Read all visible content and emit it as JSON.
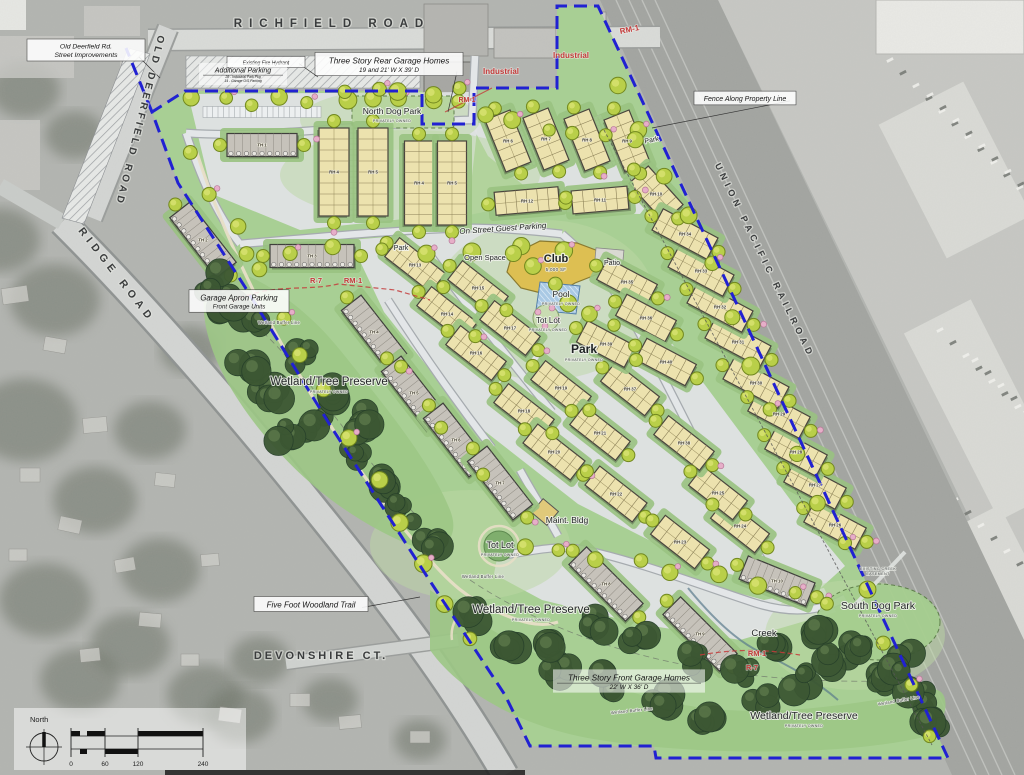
{
  "colors": {
    "boundary": "#2121d2",
    "zoning_red": "#c43b3b",
    "site_green": "#a8cf94",
    "preserve_green": "#9cc785",
    "pavement": "#dfe2e4",
    "rh_fill": "#ece2ae",
    "th_fill": "#c6c2ba",
    "club_fill": "#ddbf52",
    "pool_fill": "#a9c9e4",
    "tree_yellow": "#b9cf49",
    "tree_dark": "#3c5733",
    "shrub_pink": "#e6aec8"
  },
  "legend": {
    "north_label": "North",
    "scale_ticks": [
      "0",
      "60",
      "120",
      "240"
    ]
  },
  "labels": [
    {
      "t": "RICHFIELD ROAD",
      "x": 332,
      "y": 27,
      "s": 11.5,
      "cls": "road",
      "ls": 7
    },
    {
      "t": "OLD DEERFIELD ROAD",
      "x": 137,
      "y": 120,
      "s": 10,
      "cls": "road",
      "ls": 3.5,
      "r": 104
    },
    {
      "t": "RIDGE ROAD",
      "x": 114,
      "y": 277,
      "s": 10.5,
      "cls": "road",
      "ls": 5,
      "r": 52
    },
    {
      "t": "UNION PACIFIC RAILROAD",
      "x": 762,
      "y": 262,
      "s": 9,
      "cls": "road",
      "ls": 4.5,
      "r": 64
    },
    {
      "t": "DEVONSHIRE CT.",
      "x": 321,
      "y": 659,
      "s": 11,
      "cls": "road",
      "ls": 3
    },
    {
      "t": "RM-1",
      "x": 630,
      "y": 32,
      "s": 8,
      "cls": "red",
      "r": -12
    },
    {
      "t": "RM-1",
      "x": 467,
      "y": 102,
      "s": 7,
      "cls": "red"
    },
    {
      "t": "R-7",
      "x": 316,
      "y": 283,
      "s": 7.5,
      "cls": "red"
    },
    {
      "t": "RM-1",
      "x": 353,
      "y": 283,
      "s": 7.5,
      "cls": "red"
    },
    {
      "t": "RM-1",
      "x": 757,
      "y": 656,
      "s": 7.5,
      "cls": "red"
    },
    {
      "t": "R-7",
      "x": 752,
      "y": 670,
      "s": 7.5,
      "cls": "red"
    },
    {
      "t": "Industrial",
      "x": 501,
      "y": 74,
      "s": 8,
      "cls": "red"
    },
    {
      "t": "Industrial",
      "x": 571,
      "y": 58,
      "s": 8,
      "cls": "red"
    },
    {
      "t": "North Dog Park",
      "x": 392,
      "y": 114,
      "s": 8.5,
      "cls": "area",
      "sub": "PRIVATELY OWNED"
    },
    {
      "t": "On Street Guest Parking",
      "x": 503,
      "y": 231,
      "s": 8,
      "cls": "ital",
      "r": -4
    },
    {
      "t": "Open Space",
      "x": 485,
      "y": 260,
      "s": 7.5,
      "cls": "area"
    },
    {
      "t": "Club",
      "x": 556,
      "y": 262,
      "s": 11,
      "cls": "areaB"
    },
    {
      "t": "5,000 SF",
      "x": 556,
      "y": 271,
      "s": 4.5,
      "cls": "tiny"
    },
    {
      "t": "Patio",
      "x": 612,
      "y": 265,
      "s": 7,
      "cls": "area"
    },
    {
      "t": "Pool",
      "x": 561,
      "y": 297,
      "s": 8.5,
      "cls": "area",
      "sub": "PRIVATELY OWNED"
    },
    {
      "t": "Tot Lot",
      "x": 548,
      "y": 323,
      "s": 8,
      "cls": "area",
      "sub": "PRIVATELY OWNED"
    },
    {
      "t": "Park",
      "x": 584,
      "y": 353,
      "s": 12,
      "cls": "areaB",
      "sub": "PRIVATELY OWNED"
    },
    {
      "t": "Park",
      "x": 652,
      "y": 142,
      "s": 7,
      "cls": "area",
      "r": -12
    },
    {
      "t": "Park",
      "x": 401,
      "y": 250,
      "s": 7,
      "cls": "area"
    },
    {
      "t": "Maint. Bldg",
      "x": 567,
      "y": 523,
      "s": 8.5,
      "cls": "area"
    },
    {
      "t": "Tot Lot",
      "x": 500,
      "y": 548,
      "s": 9,
      "cls": "area",
      "sub": "PRIVATELY OWNED"
    },
    {
      "t": "South Dog Park",
      "x": 878,
      "y": 609,
      "s": 10.5,
      "cls": "area",
      "sub": "PRIVATELY OWNED"
    },
    {
      "t": "Creek",
      "x": 764,
      "y": 636,
      "s": 9.5,
      "cls": "area"
    },
    {
      "t": "Wetland/Tree Preserve",
      "x": 329,
      "y": 385,
      "s": 11.5,
      "cls": "area",
      "sub": "PRIVATELY OWNED"
    },
    {
      "t": "Wetland/Tree Preserve",
      "x": 531,
      "y": 613,
      "s": 11.5,
      "cls": "area",
      "sub": "PRIVATELY OWNED"
    },
    {
      "t": "Wetland/Tree Preserve",
      "x": 804,
      "y": 719,
      "s": 10.5,
      "cls": "area",
      "sub": "PRIVATELY OWNED"
    },
    {
      "t": "Wetland Buffer Line",
      "x": 279,
      "y": 324,
      "s": 4.2,
      "cls": "tiny"
    },
    {
      "t": "Wetland Buffer Line",
      "x": 483,
      "y": 578,
      "s": 4.2,
      "cls": "tiny"
    },
    {
      "t": "Wetland Buffer Line",
      "x": 632,
      "y": 712,
      "s": 4.2,
      "cls": "tiny",
      "r": -6
    },
    {
      "t": "Wetland Buffer Line",
      "x": 899,
      "y": 702,
      "s": 4.2,
      "cls": "tiny",
      "r": -10
    },
    {
      "t": "EXISTING CREEK",
      "x": 878,
      "y": 570,
      "s": 3.8,
      "cls": "tiny"
    },
    {
      "t": "EASEMENT",
      "x": 878,
      "y": 575,
      "s": 3.8,
      "cls": "tiny"
    }
  ],
  "callouts": [
    {
      "lines": [
        "Old Deerfield Rd.",
        "Street Improvements"
      ],
      "x": 86,
      "y": 50,
      "w": 118,
      "sizes": [
        6.8,
        6.8
      ],
      "lead": [
        160,
        78
      ]
    },
    {
      "lines": [
        "Three Story Rear Garage Homes",
        "19 and 21' W X 39' D"
      ],
      "x": 389,
      "y": 64,
      "w": 148,
      "sizes": [
        8.2,
        6.4
      ],
      "lead": [
        448,
        112
      ]
    },
    {
      "lines": [
        "Fence Along Property Line"
      ],
      "x": 745,
      "y": 98,
      "w": 102,
      "sizes": [
        7
      ],
      "lead": [
        652,
        128
      ]
    },
    {
      "lines": [
        "Five Foot Woodland Trail"
      ],
      "x": 311,
      "y": 604,
      "w": 114,
      "sizes": [
        8
      ],
      "lead": [
        420,
        597
      ]
    },
    {
      "lines": [
        "Garage Apron Parking",
        "Front Garage Units"
      ],
      "x": 239,
      "y": 301,
      "w": 100,
      "sizes": [
        7.8,
        6.2
      ]
    },
    {
      "lines": [
        "Existing Fire Hydrant"
      ],
      "x": 266,
      "y": 62,
      "w": 78,
      "sizes": [
        5
      ],
      "lead": [
        318,
        77
      ]
    },
    {
      "lines": [
        "Additional Parking",
        "28 - Industrial Park Pkg",
        "14 - Garage O/S Parking"
      ],
      "x": 243,
      "y": 74,
      "w": 88,
      "sizes": [
        7,
        3.4,
        3.4
      ],
      "nobox": true
    },
    {
      "lines": [
        "Three Story Front Garage Homes",
        "22' W X 36' D"
      ],
      "x": 629,
      "y": 681,
      "w": 152,
      "sizes": [
        8.2,
        6.4
      ],
      "nobox": true
    }
  ],
  "buildings": {
    "rh": [
      [
        "RH 4",
        334,
        172,
        88,
        30,
        90
      ],
      [
        "RH 5",
        373,
        172,
        88,
        30,
        90
      ],
      [
        "RH 4",
        419,
        183,
        84,
        29,
        90
      ],
      [
        "RH 5",
        452,
        183,
        84,
        29,
        90
      ],
      [
        "RH 6",
        508,
        141,
        56,
        27,
        68
      ],
      [
        "RH 7",
        546,
        139,
        56,
        27,
        68
      ],
      [
        "RH 8",
        587,
        140,
        56,
        27,
        68
      ],
      [
        "RH 9",
        627,
        141,
        56,
        27,
        68
      ],
      [
        "RH 10",
        656,
        194,
        52,
        26,
        48
      ],
      [
        "RH 11",
        600,
        200,
        56,
        23,
        -5
      ],
      [
        "RH 12",
        527,
        201,
        64,
        23,
        -5
      ],
      [
        "RH 13",
        415,
        265,
        58,
        24,
        38
      ],
      [
        "RH 14",
        447,
        314,
        58,
        24,
        38
      ],
      [
        "RH 15",
        478,
        288,
        58,
        24,
        38
      ],
      [
        "RH 16",
        476,
        353,
        58,
        24,
        38
      ],
      [
        "RH 17",
        510,
        328,
        58,
        24,
        38
      ],
      [
        "RH 18",
        524,
        411,
        58,
        24,
        38
      ],
      [
        "RH 19",
        561,
        388,
        58,
        24,
        38
      ],
      [
        "RH 20",
        554,
        452,
        60,
        24,
        38
      ],
      [
        "RH 21",
        600,
        433,
        58,
        24,
        38
      ],
      [
        "RH 22",
        616,
        494,
        60,
        24,
        38
      ],
      [
        "RH 23",
        680,
        542,
        56,
        24,
        38
      ],
      [
        "RH 24",
        740,
        526,
        56,
        24,
        38
      ],
      [
        "RH 25",
        718,
        493,
        56,
        24,
        38
      ],
      [
        "RH 26",
        835,
        525,
        58,
        24,
        28
      ],
      [
        "RH 27",
        815,
        485,
        58,
        24,
        28
      ],
      [
        "RH 28",
        796,
        452,
        58,
        24,
        28
      ],
      [
        "RH 29",
        779,
        414,
        58,
        24,
        28
      ],
      [
        "RH 30",
        756,
        383,
        62,
        24,
        28
      ],
      [
        "RH 31",
        738,
        342,
        62,
        24,
        28
      ],
      [
        "RH 32",
        720,
        307,
        62,
        24,
        28
      ],
      [
        "RH 33",
        701,
        271,
        62,
        24,
        28
      ],
      [
        "RH 34",
        685,
        234,
        62,
        24,
        28
      ],
      [
        "RH 35",
        627,
        282,
        56,
        24,
        28
      ],
      [
        "RH 36",
        646,
        318,
        56,
        24,
        28
      ],
      [
        "RH 37",
        630,
        389,
        56,
        24,
        38
      ],
      [
        "RH 38",
        684,
        443,
        58,
        24,
        38
      ],
      [
        "RH 39",
        606,
        344,
        54,
        24,
        28
      ],
      [
        "RH 40",
        666,
        362,
        56,
        24,
        28
      ]
    ],
    "th": [
      [
        "TH 1",
        262,
        145,
        70,
        23,
        0
      ],
      [
        "TH 2",
        203,
        240,
        76,
        25,
        52
      ],
      [
        "TH 3",
        312,
        256,
        84,
        23,
        0
      ],
      [
        "TH 4",
        374,
        332,
        74,
        25,
        52
      ],
      [
        "TH 5",
        414,
        393,
        74,
        25,
        52
      ],
      [
        "TH 6",
        456,
        440,
        74,
        25,
        52
      ],
      [
        "TH 7",
        500,
        483,
        74,
        25,
        52
      ],
      [
        "TH 8",
        606,
        584,
        80,
        25,
        45
      ],
      [
        "TH 9",
        700,
        634,
        80,
        25,
        45
      ],
      [
        "TH 10",
        777,
        581,
        72,
        25,
        22
      ]
    ]
  }
}
